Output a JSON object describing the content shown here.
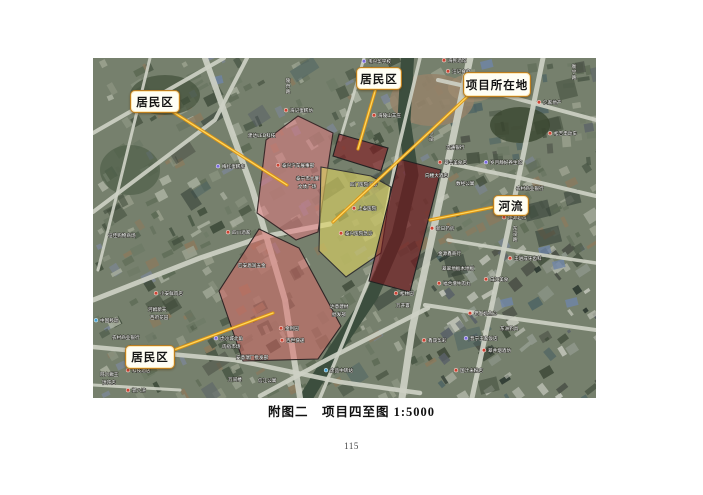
{
  "page": {
    "caption": "附图二　项目四至图  1:5000",
    "page_number": "115"
  },
  "colors": {
    "leader_outer": "#e09510",
    "leader_inner": "#ffd75e",
    "callout_border": "#bf7f1f",
    "callout_fill": "#fffef4",
    "map_base": "#76806d",
    "road": "#cdd0c4",
    "river_water": "#3c4e3e",
    "zone_residential_pink": "rgba(231,122,130,0.52)",
    "zone_dark_red": "rgba(130,26,34,0.62)",
    "zone_project_yellow": "rgba(224,214,98,0.6)"
  },
  "map": {
    "callouts": [
      {
        "name": "residential-area-nw",
        "label": "居民区",
        "box": [
          130,
          90,
          48,
          21
        ],
        "line": [
          170,
          110,
          287,
          185
        ]
      },
      {
        "name": "residential-area-n",
        "label": "居民区",
        "box": [
          356,
          67,
          44,
          21
        ],
        "line": [
          376,
          88,
          358,
          149
        ]
      },
      {
        "name": "project-site",
        "label": "项目所在地",
        "box": [
          463,
          72,
          66,
          23
        ],
        "line": [
          469,
          95,
          333,
          222
        ]
      },
      {
        "name": "river",
        "label": "河流",
        "box": [
          493,
          195,
          34,
          19
        ],
        "line": [
          494,
          207,
          430,
          220
        ]
      },
      {
        "name": "residential-area-sw",
        "label": "居民区",
        "box": [
          125,
          345,
          48,
          22
        ],
        "line": [
          174,
          350,
          273,
          313
        ]
      }
    ],
    "zones": [
      {
        "name": "residential-zone-north",
        "fill": "rgba(231,122,130,0.52)",
        "stroke": "#3a2a2a",
        "points": [
          [
            298,
            116
          ],
          [
            333,
            133
          ],
          [
            318,
            232
          ],
          [
            296,
            240
          ],
          [
            257,
            213
          ],
          [
            266,
            140
          ]
        ]
      },
      {
        "name": "residential-block-north-small",
        "fill": "rgba(130,26,34,0.62)",
        "stroke": "#222222",
        "points": [
          [
            339,
            134
          ],
          [
            388,
            148
          ],
          [
            381,
            171
          ],
          [
            333,
            156
          ]
        ]
      },
      {
        "name": "project-site-zone",
        "fill": "rgba(224,214,98,0.6)",
        "stroke": "#333333",
        "points": [
          [
            321,
            167
          ],
          [
            371,
            176
          ],
          [
            391,
            187
          ],
          [
            381,
            253
          ],
          [
            346,
            277
          ],
          [
            319,
            251
          ]
        ]
      },
      {
        "name": "river-zone",
        "fill": "rgba(112,20,28,0.64)",
        "stroke": "#222222",
        "points": [
          [
            399,
            159
          ],
          [
            441,
            170
          ],
          [
            410,
            292
          ],
          [
            369,
            281
          ]
        ]
      },
      {
        "name": "residential-zone-south",
        "fill": "rgba(222,104,104,0.5)",
        "stroke": "#2f2525",
        "points": [
          [
            259,
            229
          ],
          [
            299,
            248
          ],
          [
            341,
            326
          ],
          [
            318,
            359
          ],
          [
            243,
            361
          ],
          [
            219,
            291
          ]
        ]
      }
    ],
    "poi_labels": [
      {
        "t": "韦兴华学校",
        "x": 368,
        "y": 63,
        "c": "#7a6adf"
      },
      {
        "t": "海民酒馆",
        "x": 448,
        "y": 62,
        "c": "#cc4433"
      },
      {
        "t": "汪记食府",
        "x": 452,
        "y": 73,
        "c": "#cc4433"
      },
      {
        "t": "海记蛋糕坊",
        "x": 290,
        "y": 112,
        "c": "#cc4433"
      },
      {
        "t": "建达LED科技",
        "x": 248,
        "y": 137
      },
      {
        "t": "梅红蛋糕房",
        "x": 222,
        "y": 168,
        "c": "#7a6adf"
      },
      {
        "t": "泰兴汽车展事部",
        "x": 282,
        "y": 167,
        "c": "#cc4433"
      },
      {
        "t": "泰宁市大厦",
        "x": 296,
        "y": 180
      },
      {
        "t": "文体广场",
        "x": 298,
        "y": 188
      },
      {
        "t": "四门医院门诊",
        "x": 350,
        "y": 186
      },
      {
        "t": "上泰医院",
        "x": 358,
        "y": 210,
        "c": "#cc4433"
      },
      {
        "t": "泰兴医院急诊",
        "x": 345,
        "y": 235,
        "c": "#cc4433"
      },
      {
        "t": "四川酒家",
        "x": 232,
        "y": 234,
        "c": "#cc4433"
      },
      {
        "t": "匹安恩润五金",
        "x": 238,
        "y": 267
      },
      {
        "t": "海陵山羊庄",
        "x": 378,
        "y": 117,
        "c": "#cc4433"
      },
      {
        "t": "交通银行",
        "x": 446,
        "y": 149
      },
      {
        "t": "翠丰美食店",
        "x": 444,
        "y": 164,
        "c": "#cc4433"
      },
      {
        "t": "岁月静好养生馆",
        "x": 490,
        "y": 164,
        "c": "#7a6adf"
      },
      {
        "t": "向楼大酒店",
        "x": 425,
        "y": 177
      },
      {
        "t": "数经公寓",
        "x": 456,
        "y": 185
      },
      {
        "t": "农村商业银行",
        "x": 516,
        "y": 190
      },
      {
        "t": "亿家地产",
        "x": 543,
        "y": 104,
        "c": "#cc4433"
      },
      {
        "t": "松吉电动车",
        "x": 554,
        "y": 135,
        "c": "#cc4433"
      },
      {
        "t": "佳源超市",
        "x": 508,
        "y": 219,
        "c": "#cc4433"
      },
      {
        "t": "新日药房",
        "x": 436,
        "y": 230,
        "c": "#cc4433"
      },
      {
        "t": "金源鑫商行",
        "x": 438,
        "y": 255
      },
      {
        "t": "翠翠地板木地板",
        "x": 442,
        "y": 270
      },
      {
        "t": "福合增牛肉丸",
        "x": 443,
        "y": 285,
        "c": "#cc4433"
      },
      {
        "t": "王进成牙齿科",
        "x": 514,
        "y": 260,
        "c": "#cc4433"
      },
      {
        "t": "松林园",
        "x": 400,
        "y": 295,
        "c": "#cc4433"
      },
      {
        "t": "万开寰",
        "x": 396,
        "y": 307
      },
      {
        "t": "老大妈点心",
        "x": 474,
        "y": 315,
        "c": "#cc4433"
      },
      {
        "t": "晋宁王家饭店",
        "x": 470,
        "y": 340,
        "c": "#7a6adf"
      },
      {
        "t": "鑫晟华彩",
        "x": 428,
        "y": 342,
        "c": "#cc4433"
      },
      {
        "t": "翠井烟酒坊",
        "x": 488,
        "y": 352,
        "c": "#cc4433"
      },
      {
        "t": "国汁米粉店",
        "x": 460,
        "y": 372,
        "c": "#cc4433"
      },
      {
        "t": "东洲钓具",
        "x": 500,
        "y": 330
      },
      {
        "t": "小安鲜肉店",
        "x": 160,
        "y": 295,
        "c": "#cc4433"
      },
      {
        "t": "河姆新天",
        "x": 148,
        "y": 311
      },
      {
        "t": "西府花园",
        "x": 150,
        "y": 319
      },
      {
        "t": "中国移动",
        "x": 100,
        "y": 322,
        "c": "#46a0d0"
      },
      {
        "t": "农村商业银行",
        "x": 112,
        "y": 339
      },
      {
        "t": "虎沙城北角",
        "x": 220,
        "y": 340,
        "c": "#7a6adf"
      },
      {
        "t": "肉宿市场",
        "x": 222,
        "y": 348
      },
      {
        "t": "金利园",
        "x": 285,
        "y": 330,
        "c": "#cc4433"
      },
      {
        "t": "百世快递",
        "x": 286,
        "y": 342,
        "c": "#cc4433"
      },
      {
        "t": "达意建材",
        "x": 330,
        "y": 308
      },
      {
        "t": "批发部",
        "x": 332,
        "y": 316
      },
      {
        "t": "科技酒店",
        "x": 132,
        "y": 372,
        "c": "#cc4433"
      },
      {
        "t": "阿六瘸王",
        "x": 100,
        "y": 376
      },
      {
        "t": "馄饨店",
        "x": 102,
        "y": 384
      },
      {
        "t": "郭八湾",
        "x": 132,
        "y": 392,
        "c": "#cc4433"
      },
      {
        "t": "万间楼",
        "x": 228,
        "y": 381
      },
      {
        "t": "信江公寓",
        "x": 258,
        "y": 382
      },
      {
        "t": "安意瑞厂批发部",
        "x": 236,
        "y": 359
      },
      {
        "t": "废品中转站",
        "x": 330,
        "y": 372,
        "c": "#46a0d0"
      },
      {
        "t": "征佳购物商场",
        "x": 108,
        "y": 237
      },
      {
        "t": "白江美食",
        "x": 490,
        "y": 281,
        "c": "#cc4433"
      },
      {
        "t": "陵舟路",
        "x": 288,
        "y": 82,
        "v": true
      },
      {
        "t": "东泾路",
        "x": 515,
        "y": 230,
        "v": true
      },
      {
        "t": "衡宁路",
        "x": 574,
        "y": 68,
        "v": true
      },
      {
        "t": "小泾",
        "x": 431,
        "y": 135,
        "v": true
      }
    ]
  }
}
